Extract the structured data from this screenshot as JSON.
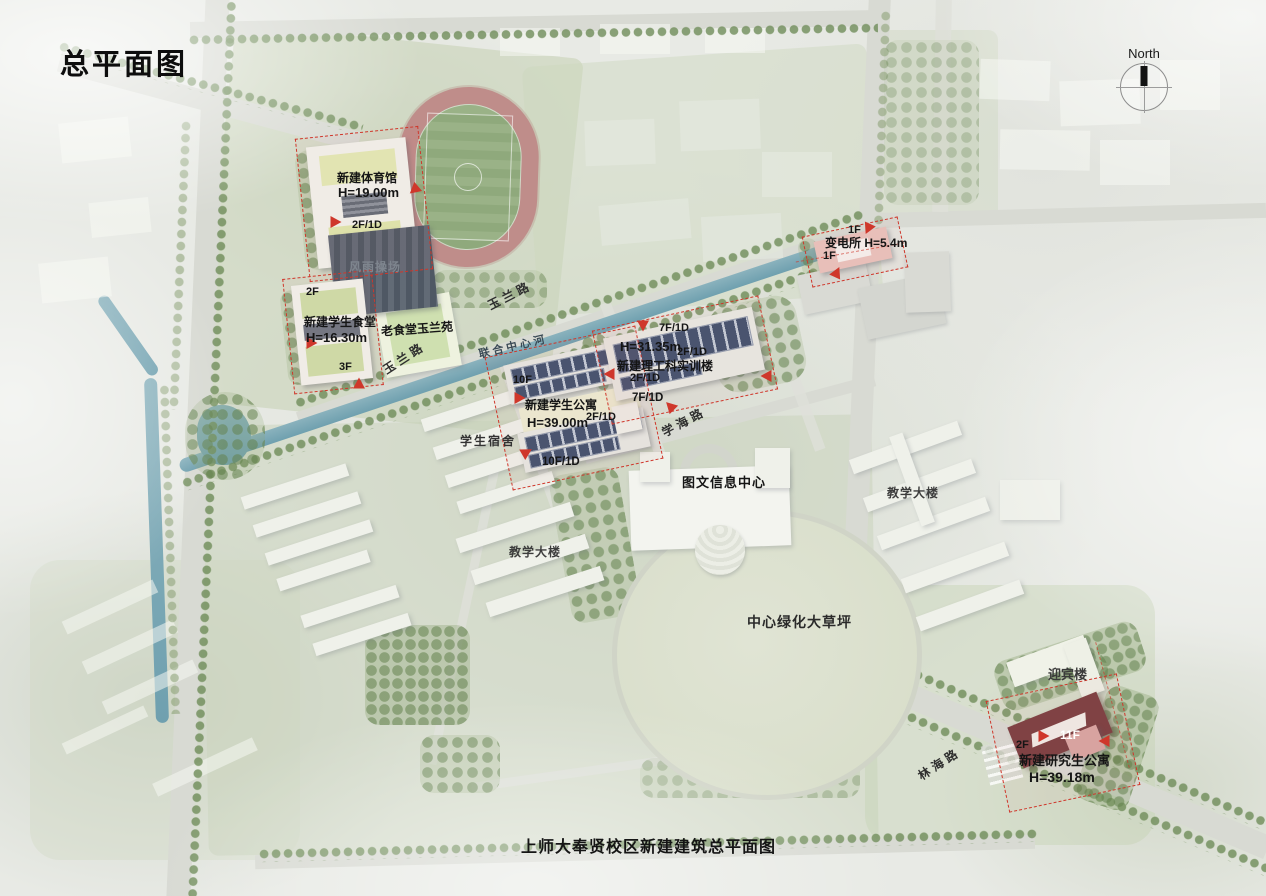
{
  "title": "总平面图",
  "caption": "上师大奉贤校区新建建筑总平面图",
  "north": {
    "label": "North"
  },
  "roads": {
    "yulan_upper": "玉兰路",
    "yulan_lower": "玉兰路",
    "xuehai": "学海路",
    "linhai": "林海路"
  },
  "water": {
    "river": "联合中心河"
  },
  "sites": {
    "gym": {
      "name": "新建体育馆",
      "height": "H=19.00m",
      "floors": "2F/1D"
    },
    "canopy_playground": {
      "name": "风雨操场"
    },
    "canteen": {
      "name": "新建学生食堂",
      "height": "H=16.30m",
      "floors_upper": "2F",
      "floors_lower": "3F"
    },
    "apartment": {
      "name": "新建学生公寓",
      "height": "H=39.00m",
      "floors": "10F",
      "floors_d": "10F/1D",
      "podium": "2F/1D"
    },
    "training": {
      "name": "新建理工科实训楼",
      "height": "H=31.35m",
      "floors_top": "7F/1D",
      "floors_bottom": "7F/1D",
      "podium_a": "2F/1D",
      "podium_b": "2F/1D"
    },
    "substation": {
      "name": "变电所 H=5.4m",
      "floors_a": "1F",
      "floors_b": "1F"
    },
    "graduate_apartment": {
      "name": "新建研究生公寓",
      "height": "H=39.18m",
      "floors": "11F",
      "podium": "2F"
    }
  },
  "places": {
    "old_canteen": "老食堂玉兰苑",
    "dormitory": "学生宿舍",
    "library": "图文信息中心",
    "teaching_left": "教学大楼",
    "teaching_right": "教学大楼",
    "lawn": "中心绿化大草坪",
    "guest_house": "迎宾楼"
  },
  "colors": {
    "entrance_marker": "#cf372b",
    "new_site_outline": "#cf372b",
    "river": "#74a2b2",
    "track_ring": "#bf8d8a",
    "field_green": "#8fa97c",
    "solar_panel": "#43536f",
    "graduate_roof": "#7c4042",
    "canopy_roof": "#525c68"
  }
}
